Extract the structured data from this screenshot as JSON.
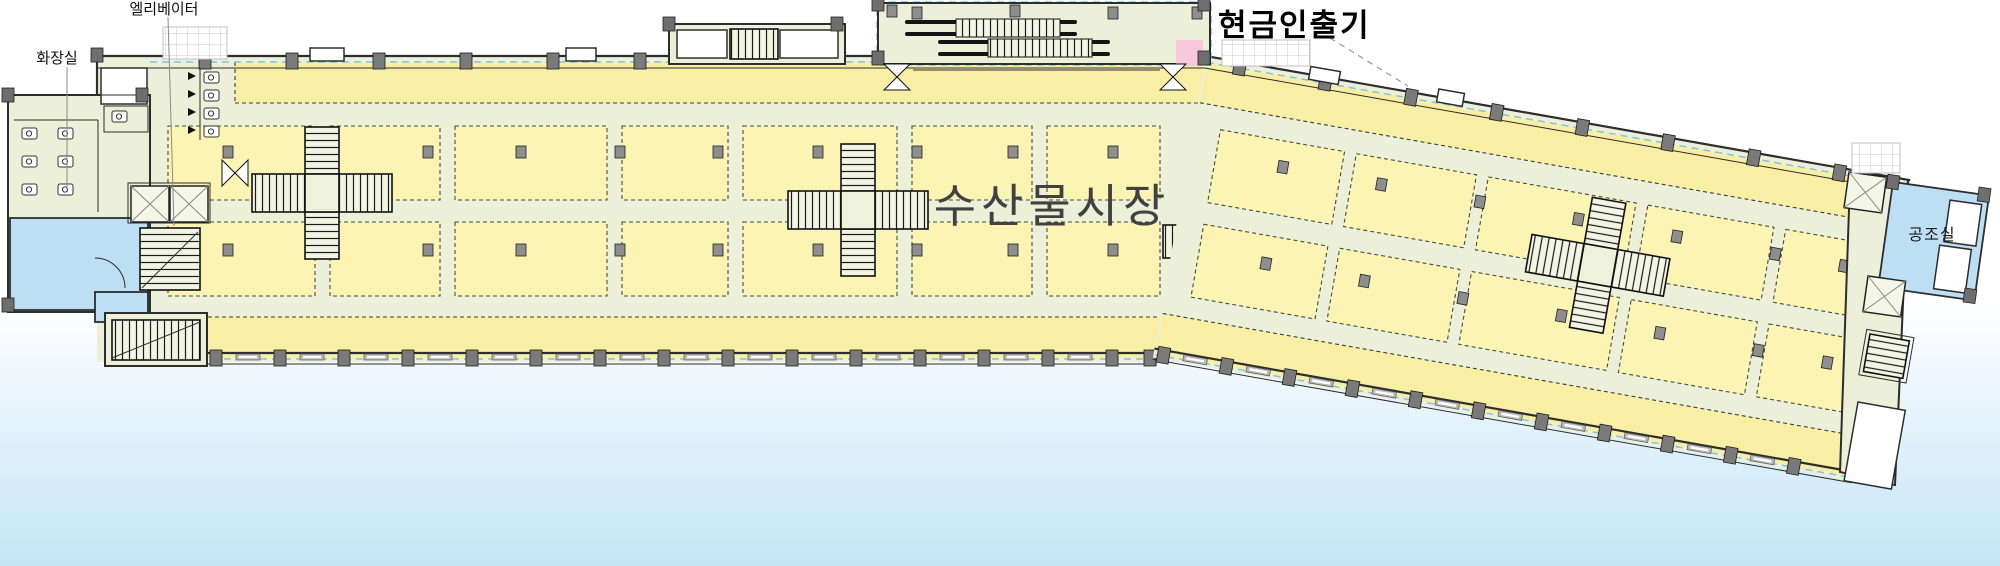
{
  "page": {
    "background_top": "#ffffff",
    "background_bottom": "#C3E5F6"
  },
  "floorplan": {
    "title": "수산물시장",
    "labels": {
      "elevator": "엘리베이터",
      "restroom": "화장실",
      "atm": "현금인출기",
      "hvac_room": "공조실"
    },
    "colors": {
      "stall_yellow": "#FBF4B2",
      "corridor_yellow": "#F8EFA4",
      "floor_cream": "#ECF0D9",
      "water_blue": "#BCDFF3",
      "atm_pink": "#F9C9DB",
      "wall_dark": "#2D2D2D",
      "column_gray": "#8E8E8E",
      "glazing_blue": "#7CC4EC",
      "title_gray": "#414141",
      "sky_blue": "#C3E5F6"
    }
  }
}
